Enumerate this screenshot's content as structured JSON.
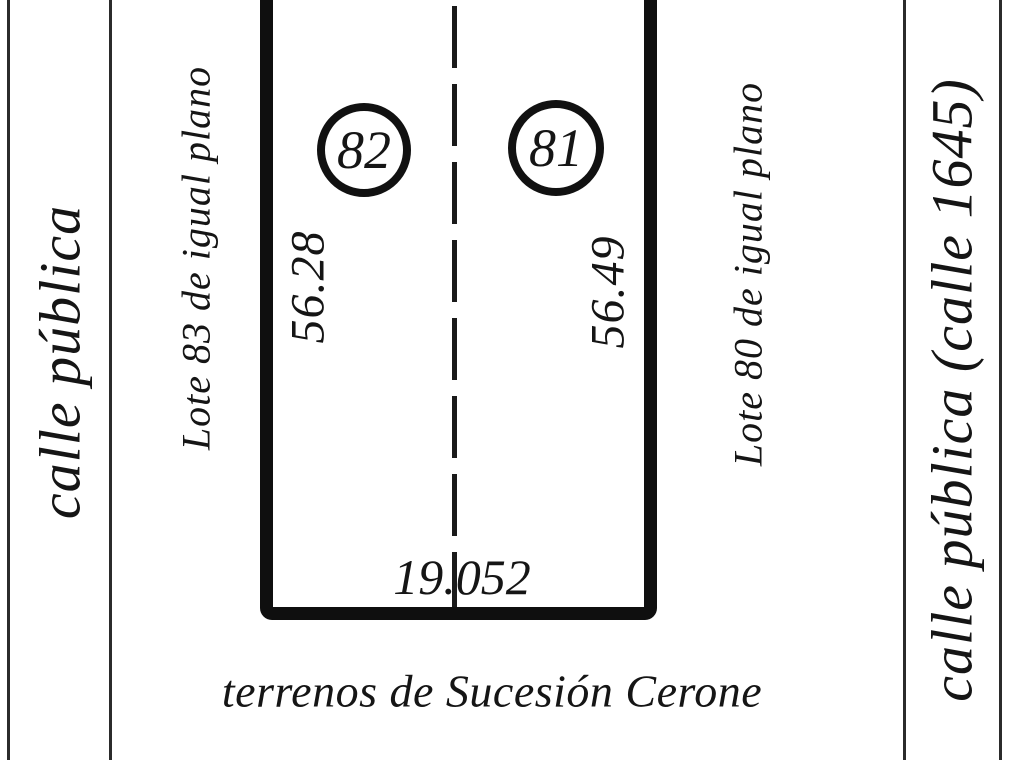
{
  "colors": {
    "ink": "#151515",
    "background": "#ffffff"
  },
  "streets": {
    "left_label": "calle pública",
    "right_label": "calle pública (calle 1645)"
  },
  "lots": {
    "left": {
      "number": "82",
      "depth": "56.28"
    },
    "right": {
      "number": "81",
      "depth": "56.49"
    },
    "frontage": "19.052"
  },
  "neighbors": {
    "left_label": "Lote 83 de igual plano",
    "right_label": "Lote 80 de igual plano",
    "bottom_label": "terrenos de Sucesión Cerone"
  }
}
